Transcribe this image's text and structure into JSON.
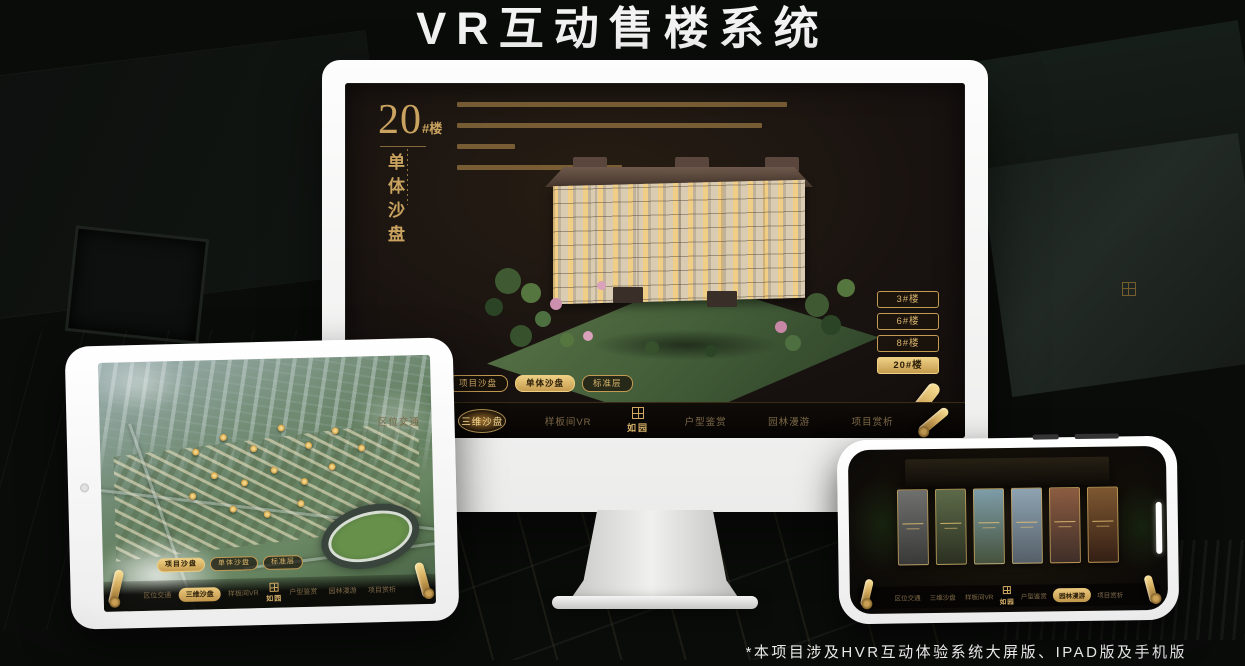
{
  "page": {
    "title": "VR互动售楼系统",
    "footnote": "*本项目涉及HVR互动体验系统大屏版、IPAD版及手机版",
    "colors": {
      "background": "#0a0c0a",
      "gold": "#d2a960",
      "gold_bright": "#eecf83",
      "gold_dim": "#7d6947",
      "screen_bg": "#171210",
      "device_frame": "#f5f5f4",
      "active_text": "#2a1d08"
    }
  },
  "monitor": {
    "screen_title": {
      "number": "20",
      "suffix": "#楼",
      "vertical": "单体沙盘"
    },
    "floor_buttons": [
      {
        "label": "3#楼",
        "active": false
      },
      {
        "label": "6#楼",
        "active": false
      },
      {
        "label": "8#楼",
        "active": false
      },
      {
        "label": "20#楼",
        "active": true
      }
    ],
    "sub_tabs": [
      {
        "label": "项目沙盘",
        "active": false
      },
      {
        "label": "单体沙盘",
        "active": true
      },
      {
        "label": "标准层",
        "active": false
      }
    ],
    "nav": {
      "logo": "如园",
      "items": [
        {
          "label": "区位交通",
          "active": false
        },
        {
          "label": "三维沙盘",
          "active": true
        },
        {
          "label": "样板间VR",
          "active": false
        },
        {
          "label": "户型鉴赏",
          "active": false
        },
        {
          "label": "园林漫游",
          "active": false
        },
        {
          "label": "项目赏析",
          "active": false
        }
      ]
    }
  },
  "tablet": {
    "sub_tabs": [
      {
        "label": "项目沙盘",
        "active": true
      },
      {
        "label": "单体沙盘",
        "active": false
      },
      {
        "label": "标准层",
        "active": false
      }
    ],
    "nav": {
      "logo": "如园",
      "items": [
        {
          "label": "区位交通",
          "active": false
        },
        {
          "label": "三维沙盘",
          "active": true
        },
        {
          "label": "样板间VR",
          "active": false
        },
        {
          "label": "户型鉴赏",
          "active": false
        },
        {
          "label": "园林漫游",
          "active": false
        },
        {
          "label": "项目赏析",
          "active": false
        }
      ]
    }
  },
  "phone": {
    "nav": {
      "logo": "如园",
      "items": [
        {
          "label": "区位交通",
          "active": false
        },
        {
          "label": "三维沙盘",
          "active": false
        },
        {
          "label": "样板间VR",
          "active": false
        },
        {
          "label": "户型鉴赏",
          "active": false
        },
        {
          "label": "园林漫游",
          "active": true
        },
        {
          "label": "项目赏析",
          "active": false
        }
      ]
    }
  }
}
